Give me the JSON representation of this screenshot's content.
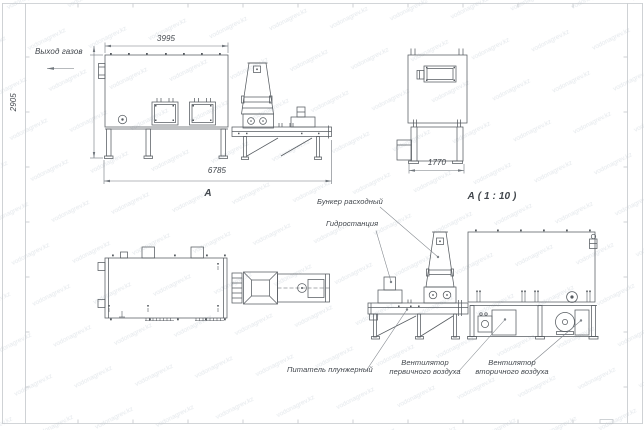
{
  "watermark": {
    "text": "vodonagrev.kz",
    "color": "#e4e8ec"
  },
  "sheet": {
    "background": "#ffffff",
    "frame_color": "#c3c7cb"
  },
  "colors": {
    "line": "#565b60",
    "dim": "#70767c",
    "leader": "#7d8288",
    "text": "#41464c"
  },
  "side_view_a": {
    "label": "А",
    "annotations": {
      "gas_outlet": "Выход газов"
    },
    "dimensions": {
      "top_width": "3995",
      "height": "2905",
      "total_length": "6785"
    }
  },
  "end_view_a": {
    "label": "А ( 1 : 10 )",
    "dimensions": {
      "width": "1770"
    }
  },
  "side_view_b": {
    "annotations": {
      "hopper": "Бункер расходный",
      "hydraulic_station": "Гидростанция",
      "feeder": "Питатель плунжерный",
      "primary_fan_line1": "Вентилятор",
      "primary_fan_line2": "первичного воздуха",
      "secondary_fan_line1": "Вентилятор",
      "secondary_fan_line2": "вторичного воздуха"
    }
  }
}
